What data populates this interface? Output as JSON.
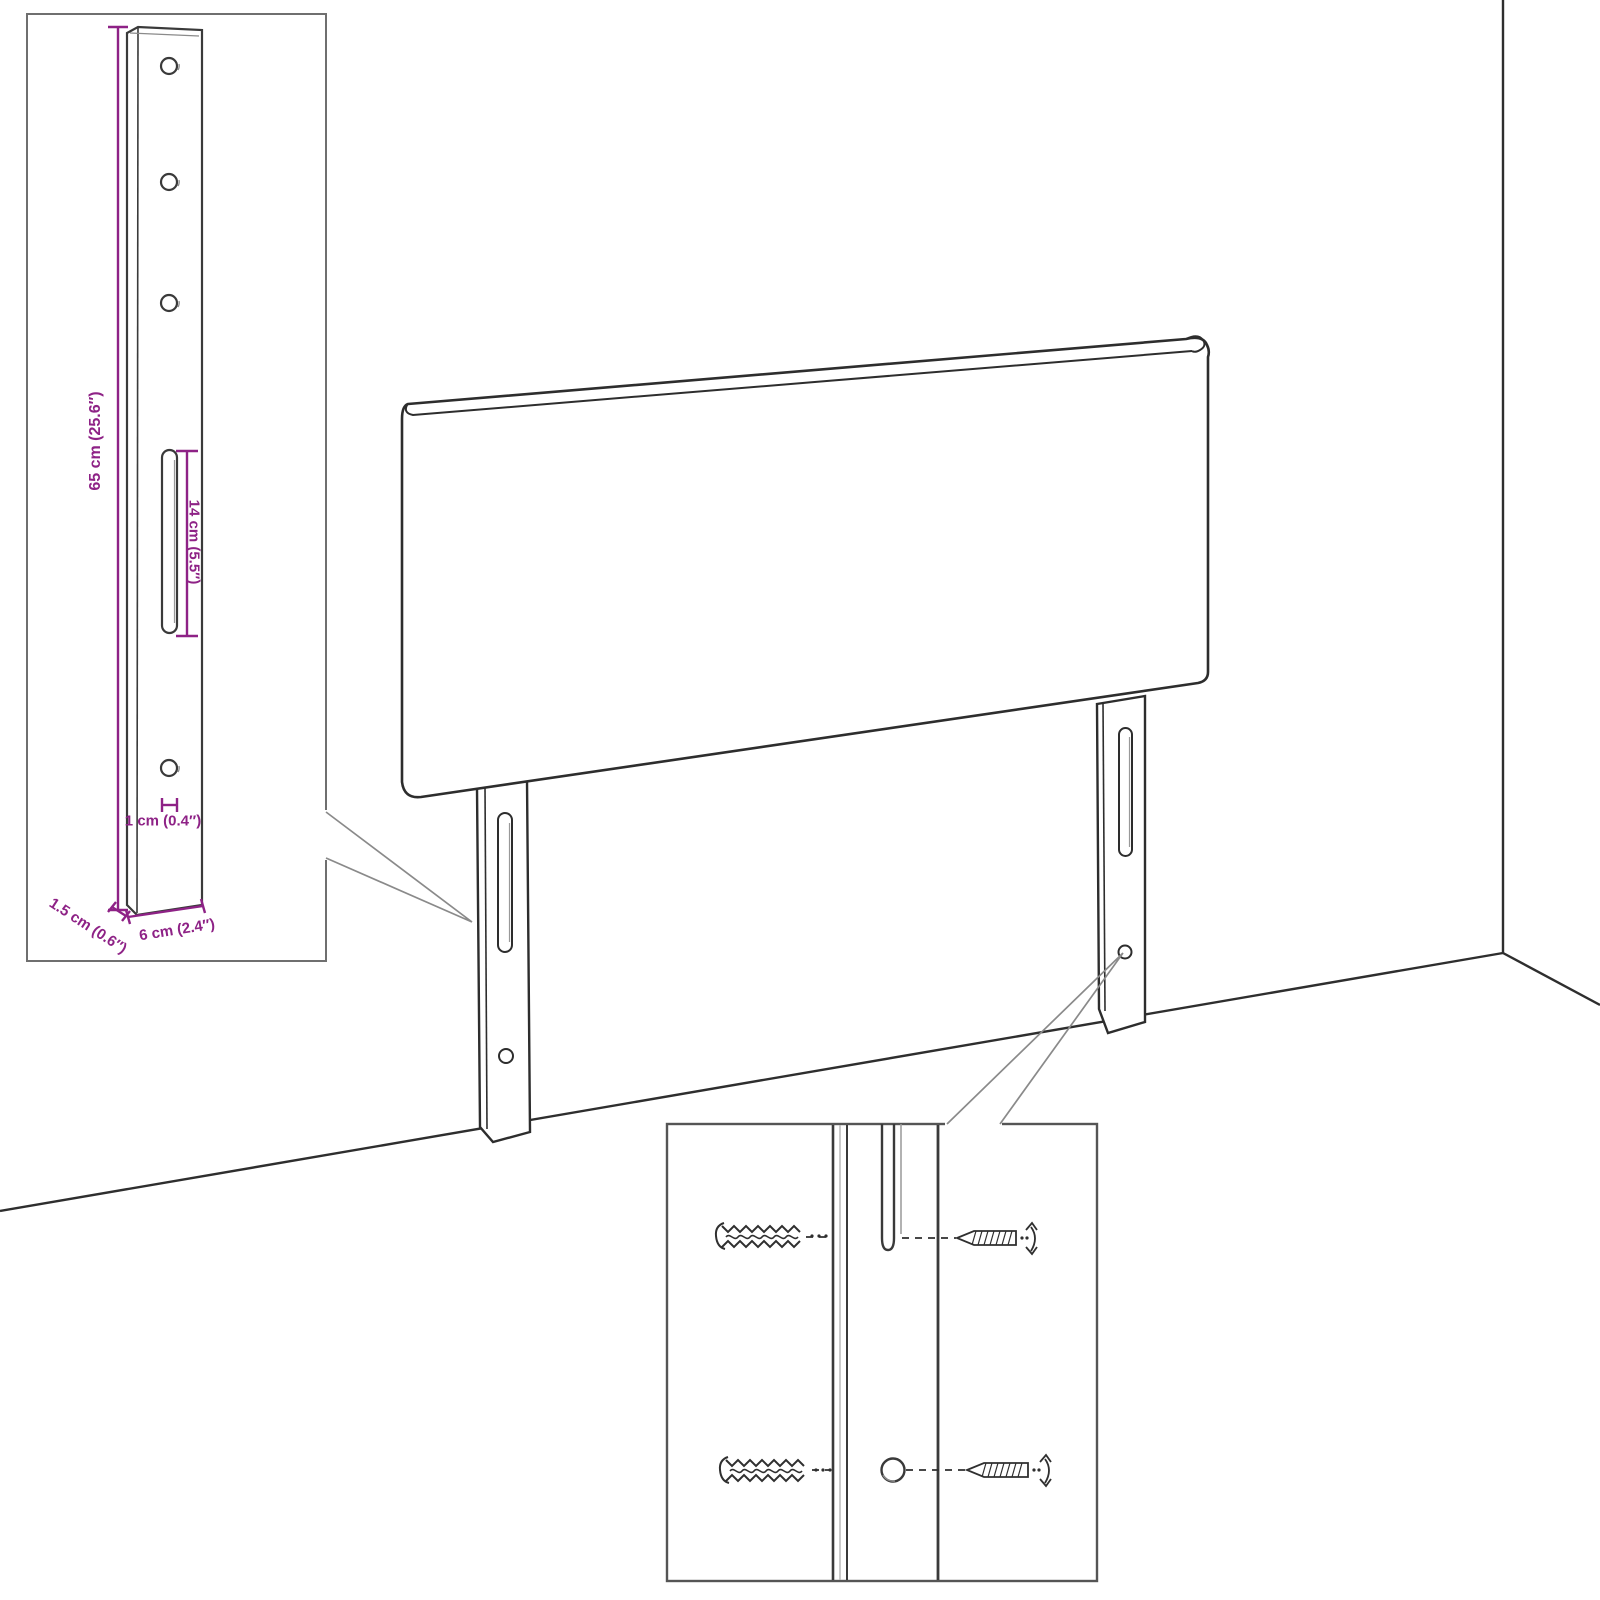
{
  "colors": {
    "dimension": "#8e2286",
    "artwork_line": "#2d2d2d",
    "inset_border": "#6f6f6f",
    "callout_line": "#8a8a8a"
  },
  "bracket_inset": {
    "height_label": "65 cm (25.6″)",
    "slot_length_label": "14 cm (5.5″)",
    "hole_diameter_label": "1 cm (0.4″)",
    "thickness_label": "1.5 cm (0.6″)",
    "width_label": "6 cm (2.4″)"
  }
}
